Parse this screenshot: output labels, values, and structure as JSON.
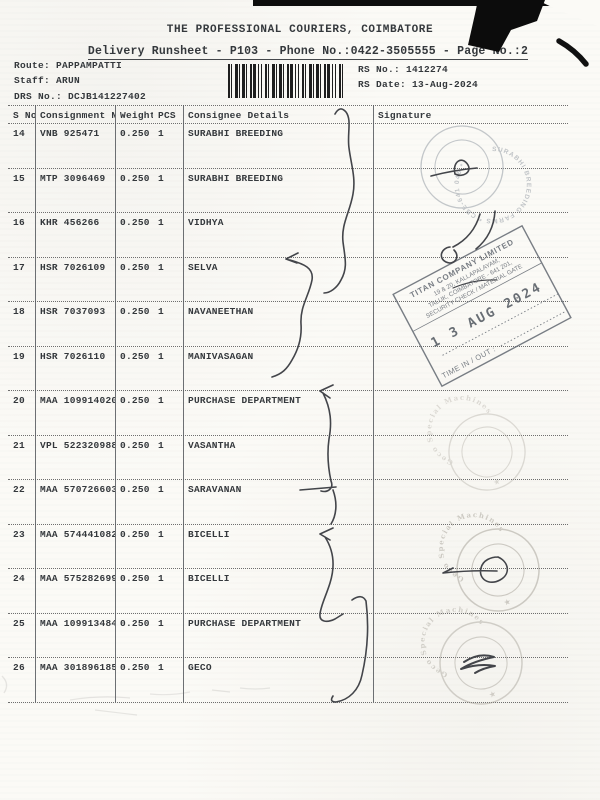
{
  "header": {
    "company": "THE PROFESSIONAL COURIERS, COIMBATORE",
    "runsheet_line": "Delivery Runsheet - P103 - Phone No.:0422-3505555 - Page No.:2"
  },
  "meta": {
    "route_label": "Route:",
    "route_value": "PAPPAMPATTI",
    "staff_label": "Staff:",
    "staff_value": "ARUN",
    "drs_label": "DRS No.:",
    "drs_value": "DCJB141227402",
    "rs_no_label": "RS No.:",
    "rs_no_value": "1412274",
    "rs_date_label": "RS Date:",
    "rs_date_value": "13-Aug-2024"
  },
  "table": {
    "headers": {
      "s_no": "S No",
      "consignment_no": "Consignment No",
      "weight": "Weight",
      "pcs": "PCS",
      "consignee": "Consignee Details",
      "signature": "Signature"
    },
    "rows": [
      {
        "s_no": "14",
        "consignment_no": "VNB 925471",
        "weight": "0.250",
        "pcs": "1",
        "consignee": "SURABHI BREEDING"
      },
      {
        "s_no": "15",
        "consignment_no": "MTP 3096469",
        "weight": "0.250",
        "pcs": "1",
        "consignee": "SURABHI BREEDING"
      },
      {
        "s_no": "16",
        "consignment_no": "KHR 456266",
        "weight": "0.250",
        "pcs": "1",
        "consignee": "VIDHYA"
      },
      {
        "s_no": "17",
        "consignment_no": "HSR 7026109",
        "weight": "0.250",
        "pcs": "1",
        "consignee": "SELVA"
      },
      {
        "s_no": "18",
        "consignment_no": "HSR 7037093",
        "weight": "0.250",
        "pcs": "1",
        "consignee": "NAVANEETHAN"
      },
      {
        "s_no": "19",
        "consignment_no": "HSR 7026110",
        "weight": "0.250",
        "pcs": "1",
        "consignee": "MANIVASAGAN"
      },
      {
        "s_no": "20",
        "consignment_no": "MAA 109914020",
        "weight": "0.250",
        "pcs": "1",
        "consignee": "PURCHASE DEPARTMENT"
      },
      {
        "s_no": "21",
        "consignment_no": "VPL 522320988",
        "weight": "0.250",
        "pcs": "1",
        "consignee": "VASANTHA"
      },
      {
        "s_no": "22",
        "consignment_no": "MAA 570726603",
        "weight": "0.250",
        "pcs": "1",
        "consignee": "SARAVANAN"
      },
      {
        "s_no": "23",
        "consignment_no": "MAA 574441082",
        "weight": "0.250",
        "pcs": "1",
        "consignee": "BICELLI"
      },
      {
        "s_no": "24",
        "consignment_no": "MAA 575282699",
        "weight": "0.250",
        "pcs": "1",
        "consignee": "BICELLI"
      },
      {
        "s_no": "25",
        "consignment_no": "MAA 109913484",
        "weight": "0.250",
        "pcs": "1",
        "consignee": "PURCHASE DEPARTMENT"
      },
      {
        "s_no": "26",
        "consignment_no": "MAA 301896185",
        "weight": "0.250",
        "pcs": "1",
        "consignee": "GECO"
      }
    ]
  },
  "stamps": {
    "surabhi_circle": {
      "ring_text": "SURABHI BREEDING FARMS * CBE-641 046 *"
    },
    "titan": {
      "line1": "TITAN COMPANY LIMITED",
      "line2": "19 & 20, KALLAPALAYAM,",
      "line3": "TALUK, COIMBATORE - 641 201,",
      "line4": "SECURITY CHECK / MATERIAL GATE",
      "date": "1 3 AUG 2024",
      "time_label": "TIME IN / OUT :"
    },
    "geco_circle": {
      "ring_text": "Geco Special Machines",
      "star": "★"
    }
  },
  "colors": {
    "ink": "#34383c",
    "pen": "#43454a",
    "stamp_gray": "#6a7078",
    "stamp_faint": "#9a958b"
  }
}
